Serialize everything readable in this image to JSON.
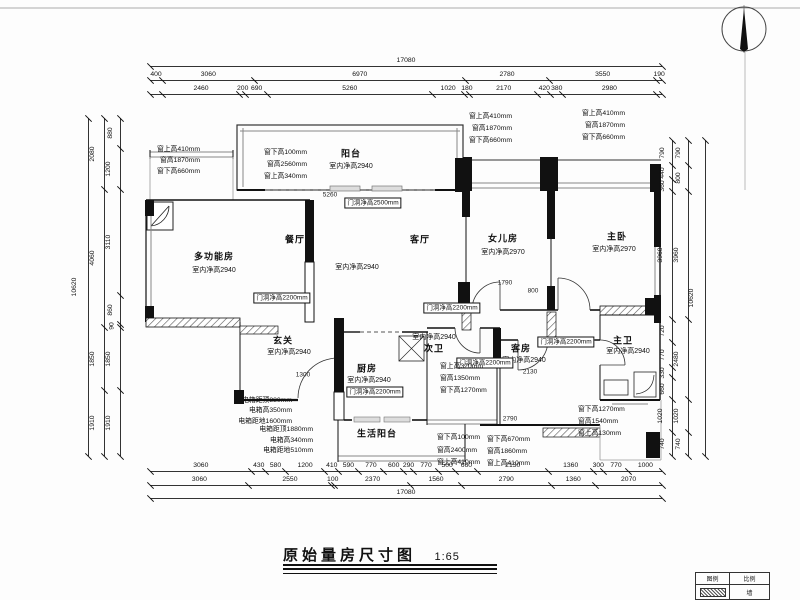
{
  "meta": {
    "title": "原始量房尺寸图",
    "scale": "1:65"
  },
  "legend": {
    "c1": "图例",
    "c2": "比例",
    "c3": "墙"
  },
  "plan_texts": [
    {
      "t": "阳台",
      "x": 351,
      "y": 153,
      "k": "room"
    },
    {
      "t": "室内净高2940",
      "x": 351,
      "y": 166,
      "k": "sub"
    },
    {
      "t": "多功能房",
      "x": 214,
      "y": 256,
      "k": "room"
    },
    {
      "t": "室内净高2940",
      "x": 214,
      "y": 270,
      "k": "sub"
    },
    {
      "t": "餐厅",
      "x": 295,
      "y": 239,
      "k": "room"
    },
    {
      "t": "客厅",
      "x": 420,
      "y": 239,
      "k": "room"
    },
    {
      "t": "室内净高2940",
      "x": 357,
      "y": 267,
      "k": "sub"
    },
    {
      "t": "女儿房",
      "x": 503,
      "y": 238,
      "k": "room"
    },
    {
      "t": "室内净高2970",
      "x": 503,
      "y": 252,
      "k": "sub"
    },
    {
      "t": "主卧",
      "x": 617,
      "y": 236,
      "k": "room"
    },
    {
      "t": "室内净高2970",
      "x": 614,
      "y": 249,
      "k": "sub"
    },
    {
      "t": "玄关",
      "x": 283,
      "y": 340,
      "k": "room"
    },
    {
      "t": "室内净高2940",
      "x": 289,
      "y": 352,
      "k": "sub"
    },
    {
      "t": "厨房",
      "x": 367,
      "y": 368,
      "k": "room"
    },
    {
      "t": "室内净高2940",
      "x": 369,
      "y": 380,
      "k": "sub"
    },
    {
      "t": "室内净高2940",
      "x": 434,
      "y": 337,
      "k": "sub"
    },
    {
      "t": "次卫",
      "x": 434,
      "y": 348,
      "k": "room"
    },
    {
      "t": "客房",
      "x": 521,
      "y": 348,
      "k": "room"
    },
    {
      "t": "室内净高2940",
      "x": 524,
      "y": 360,
      "k": "sub"
    },
    {
      "t": "主卫",
      "x": 623,
      "y": 340,
      "k": "room"
    },
    {
      "t": "室内净高2940",
      "x": 628,
      "y": 351,
      "k": "sub"
    },
    {
      "t": "生活阳台",
      "x": 377,
      "y": 433,
      "k": "room"
    },
    {
      "t": "门洞净高2500mm",
      "x": 373,
      "y": 203,
      "k": "box"
    },
    {
      "t": "门洞净高2200mm",
      "x": 282,
      "y": 298,
      "k": "box"
    },
    {
      "t": "门洞净高2200mm",
      "x": 452,
      "y": 308,
      "k": "box"
    },
    {
      "t": "门洞净高2200mm",
      "x": 566,
      "y": 342,
      "k": "box"
    },
    {
      "t": "门洞净高2200mm",
      "x": 375,
      "y": 392,
      "k": "box"
    },
    {
      "t": "门洞净高2200mm",
      "x": 485,
      "y": 363,
      "k": "box"
    },
    {
      "t": "窗上高410mm",
      "x": 200,
      "y": 148,
      "k": "ann",
      "a": "r"
    },
    {
      "t": "窗高1870mm",
      "x": 200,
      "y": 159,
      "k": "ann",
      "a": "r"
    },
    {
      "t": "窗下高660mm",
      "x": 200,
      "y": 170,
      "k": "ann",
      "a": "r"
    },
    {
      "t": "窗下高100mm",
      "x": 307,
      "y": 151,
      "k": "ann",
      "a": "r"
    },
    {
      "t": "窗高2560mm",
      "x": 307,
      "y": 163,
      "k": "ann",
      "a": "r"
    },
    {
      "t": "窗上高340mm",
      "x": 307,
      "y": 175,
      "k": "ann",
      "a": "r"
    },
    {
      "t": "窗上高410mm",
      "x": 512,
      "y": 115,
      "k": "ann",
      "a": "r"
    },
    {
      "t": "窗高1870mm",
      "x": 512,
      "y": 127,
      "k": "ann",
      "a": "r"
    },
    {
      "t": "窗下高660mm",
      "x": 512,
      "y": 139,
      "k": "ann",
      "a": "r"
    },
    {
      "t": "窗上高410mm",
      "x": 625,
      "y": 112,
      "k": "ann",
      "a": "r"
    },
    {
      "t": "窗高1870mm",
      "x": 625,
      "y": 124,
      "k": "ann",
      "a": "r"
    },
    {
      "t": "窗下高660mm",
      "x": 625,
      "y": 136,
      "k": "ann",
      "a": "r"
    },
    {
      "t": "窗上高320mm",
      "x": 440,
      "y": 365,
      "k": "ann",
      "a": "l"
    },
    {
      "t": "窗高1350mm",
      "x": 440,
      "y": 377,
      "k": "ann",
      "a": "l"
    },
    {
      "t": "窗下高1270mm",
      "x": 440,
      "y": 389,
      "k": "ann",
      "a": "l"
    },
    {
      "t": "窗下高100mm",
      "x": 437,
      "y": 436,
      "k": "ann",
      "a": "l"
    },
    {
      "t": "窗高2400mm",
      "x": 437,
      "y": 449,
      "k": "ann",
      "a": "l"
    },
    {
      "t": "窗上高410mm",
      "x": 437,
      "y": 461,
      "k": "ann",
      "a": "l"
    },
    {
      "t": "窗下高670mm",
      "x": 487,
      "y": 438,
      "k": "ann",
      "a": "l"
    },
    {
      "t": "窗高1860mm",
      "x": 487,
      "y": 450,
      "k": "ann",
      "a": "l"
    },
    {
      "t": "窗上高410mm",
      "x": 487,
      "y": 462,
      "k": "ann",
      "a": "l"
    },
    {
      "t": "窗下高1270mm",
      "x": 578,
      "y": 408,
      "k": "ann",
      "a": "l"
    },
    {
      "t": "窗高1540mm",
      "x": 578,
      "y": 420,
      "k": "ann",
      "a": "l"
    },
    {
      "t": "窗上高130mm",
      "x": 578,
      "y": 432,
      "k": "ann",
      "a": "l"
    },
    {
      "t": "电箱距顶880mm",
      "x": 292,
      "y": 399,
      "k": "ann",
      "a": "r"
    },
    {
      "t": "电箱高350mm",
      "x": 292,
      "y": 409,
      "k": "ann",
      "a": "r"
    },
    {
      "t": "电箱距地1600mm",
      "x": 292,
      "y": 420,
      "k": "ann",
      "a": "r"
    },
    {
      "t": "电箱距顶1880mm",
      "x": 313,
      "y": 428,
      "k": "ann",
      "a": "r"
    },
    {
      "t": "电箱高340mm",
      "x": 313,
      "y": 439,
      "k": "ann",
      "a": "r"
    },
    {
      "t": "电箱距地510mm",
      "x": 313,
      "y": 449,
      "k": "ann",
      "a": "r"
    },
    {
      "t": "5260",
      "x": 330,
      "y": 195,
      "k": "dim"
    },
    {
      "t": "1790",
      "x": 505,
      "y": 283,
      "k": "dim"
    },
    {
      "t": "800",
      "x": 533,
      "y": 291,
      "k": "dim"
    },
    {
      "t": "2130",
      "x": 530,
      "y": 372,
      "k": "dim"
    },
    {
      "t": "2790",
      "x": 510,
      "y": 419,
      "k": "dim"
    },
    {
      "t": "1300",
      "x": 303,
      "y": 375,
      "k": "dim"
    }
  ],
  "dimensions": [
    {
      "o": "h",
      "x": 150,
      "y": 66,
      "len": 512,
      "segs": [
        [
          17080
        ]
      ]
    },
    {
      "o": "h",
      "x": 150,
      "y": 80,
      "len": 512,
      "segs": [
        [
          400
        ],
        [
          3060
        ],
        [
          6970
        ],
        [
          2780
        ],
        [
          3550
        ],
        [
          190
        ]
      ]
    },
    {
      "o": "h",
      "x": 150,
      "y": 94,
      "len": 512,
      "segs": [
        [
          400,
          ""
        ],
        [
          2460
        ],
        [
          200
        ],
        [
          690
        ],
        [
          5260
        ],
        [
          1020
        ],
        [
          180
        ],
        [
          2170
        ],
        [
          420
        ],
        [
          380
        ],
        [
          2980
        ],
        [
          190,
          ""
        ]
      ]
    },
    {
      "o": "h",
      "x": 150,
      "y": 471,
      "len": 512,
      "segs": [
        [
          3060
        ],
        [
          430
        ],
        [
          580
        ],
        [
          1200
        ],
        [
          410
        ],
        [
          590
        ],
        [
          770
        ],
        [
          600
        ],
        [
          290
        ],
        [
          770
        ],
        [
          500
        ],
        [
          660
        ],
        [
          2130
        ],
        [
          1360
        ],
        [
          300
        ],
        [
          770
        ],
        [
          1000
        ]
      ]
    },
    {
      "o": "h",
      "x": 150,
      "y": 485,
      "len": 512,
      "segs": [
        [
          3060
        ],
        [
          2550
        ],
        [
          100
        ],
        [
          2370
        ],
        [
          1560
        ],
        [
          2790
        ],
        [
          1360
        ],
        [
          2070
        ]
      ]
    },
    {
      "o": "h",
      "x": 150,
      "y": 498,
      "len": 512,
      "segs": [
        [
          17080
        ]
      ]
    },
    {
      "o": "v",
      "x": 88,
      "y": 118,
      "len": 338,
      "segs": [
        [
          10620
        ]
      ]
    },
    {
      "o": "v",
      "x": 104,
      "y": 118,
      "len": 338,
      "segs": [
        [
          2080
        ],
        [
          4060
        ],
        [
          1850
        ],
        [
          1910
        ]
      ]
    },
    {
      "o": "v",
      "x": 120,
      "y": 118,
      "len": 338,
      "segs": [
        [
          880
        ],
        [
          1200
        ],
        [
          3110
        ],
        [
          860
        ],
        [
          90
        ],
        [
          1850
        ],
        [
          1910
        ]
      ]
    },
    {
      "o": "v",
      "x": 672,
      "y": 140,
      "len": 316,
      "segs": [
        [
          790
        ],
        [
          440
        ],
        [
          360
        ],
        [
          3960
        ],
        [
          720
        ],
        [
          770
        ],
        [
          330
        ],
        [
          660
        ],
        [
          1020
        ],
        [
          740
        ]
      ]
    },
    {
      "o": "v",
      "x": 688,
      "y": 140,
      "len": 316,
      "segs": [
        [
          790
        ],
        [
          800
        ],
        [
          3960
        ],
        [
          2480
        ],
        [
          1020
        ],
        [
          740
        ]
      ]
    },
    {
      "o": "v",
      "x": 705,
      "y": 140,
      "len": 316,
      "segs": [
        [
          10620
        ]
      ]
    }
  ]
}
